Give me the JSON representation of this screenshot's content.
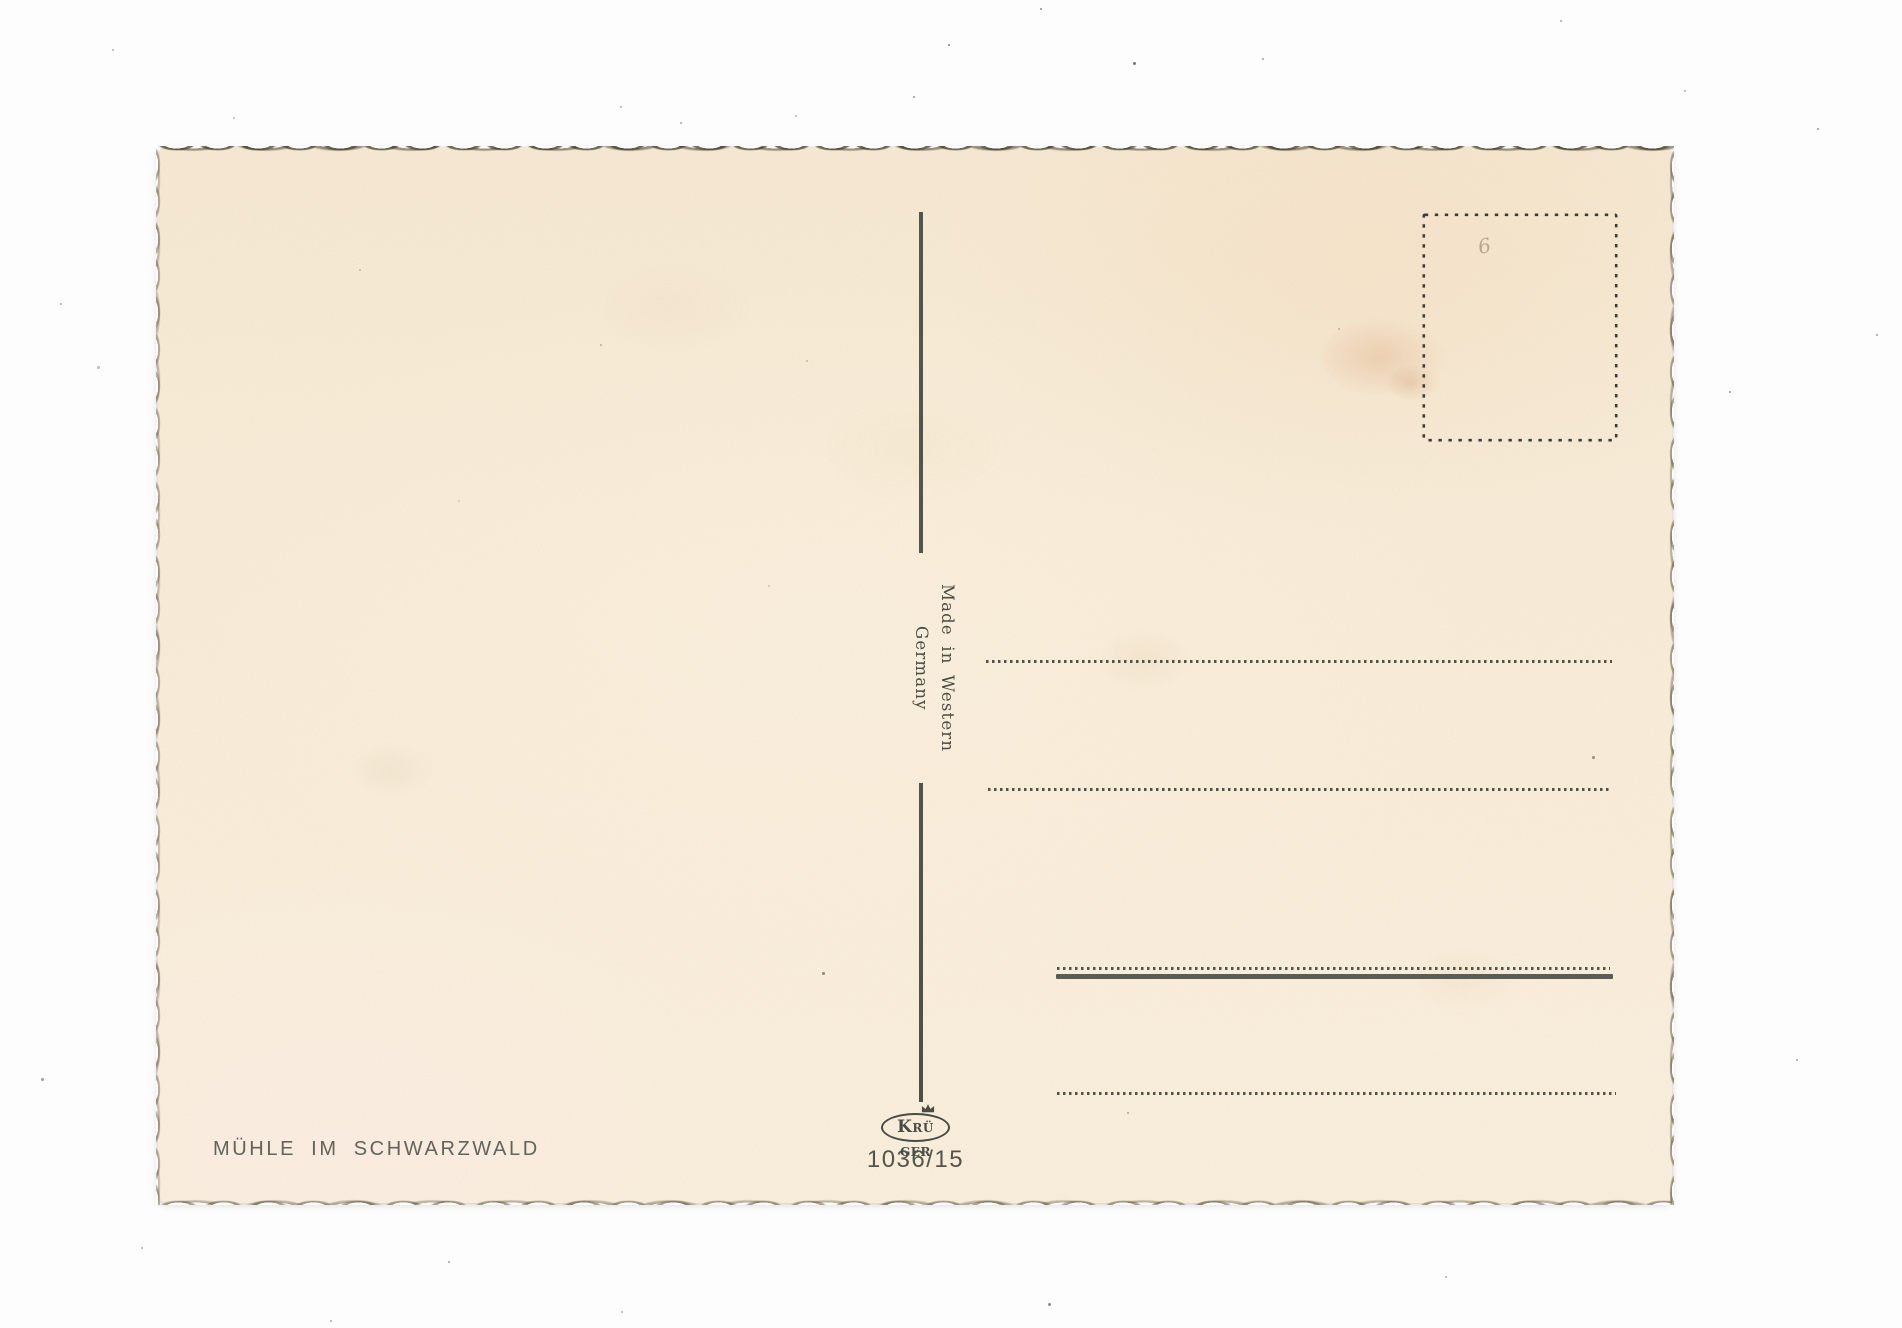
{
  "card": {
    "caption": "MÜHLE IM SCHWARZWALD",
    "made_in": "Made in Western Germany",
    "publisher": {
      "name": "KRÜGER",
      "k": "K",
      "r": "R",
      "u": "Ü",
      "ger": "GER",
      "item_number": "1036/15"
    },
    "pencil_mark": "6",
    "colors": {
      "paper": "#f8ecd8",
      "ink": "#4e4f47",
      "page_background": "#fdfdfd"
    }
  }
}
